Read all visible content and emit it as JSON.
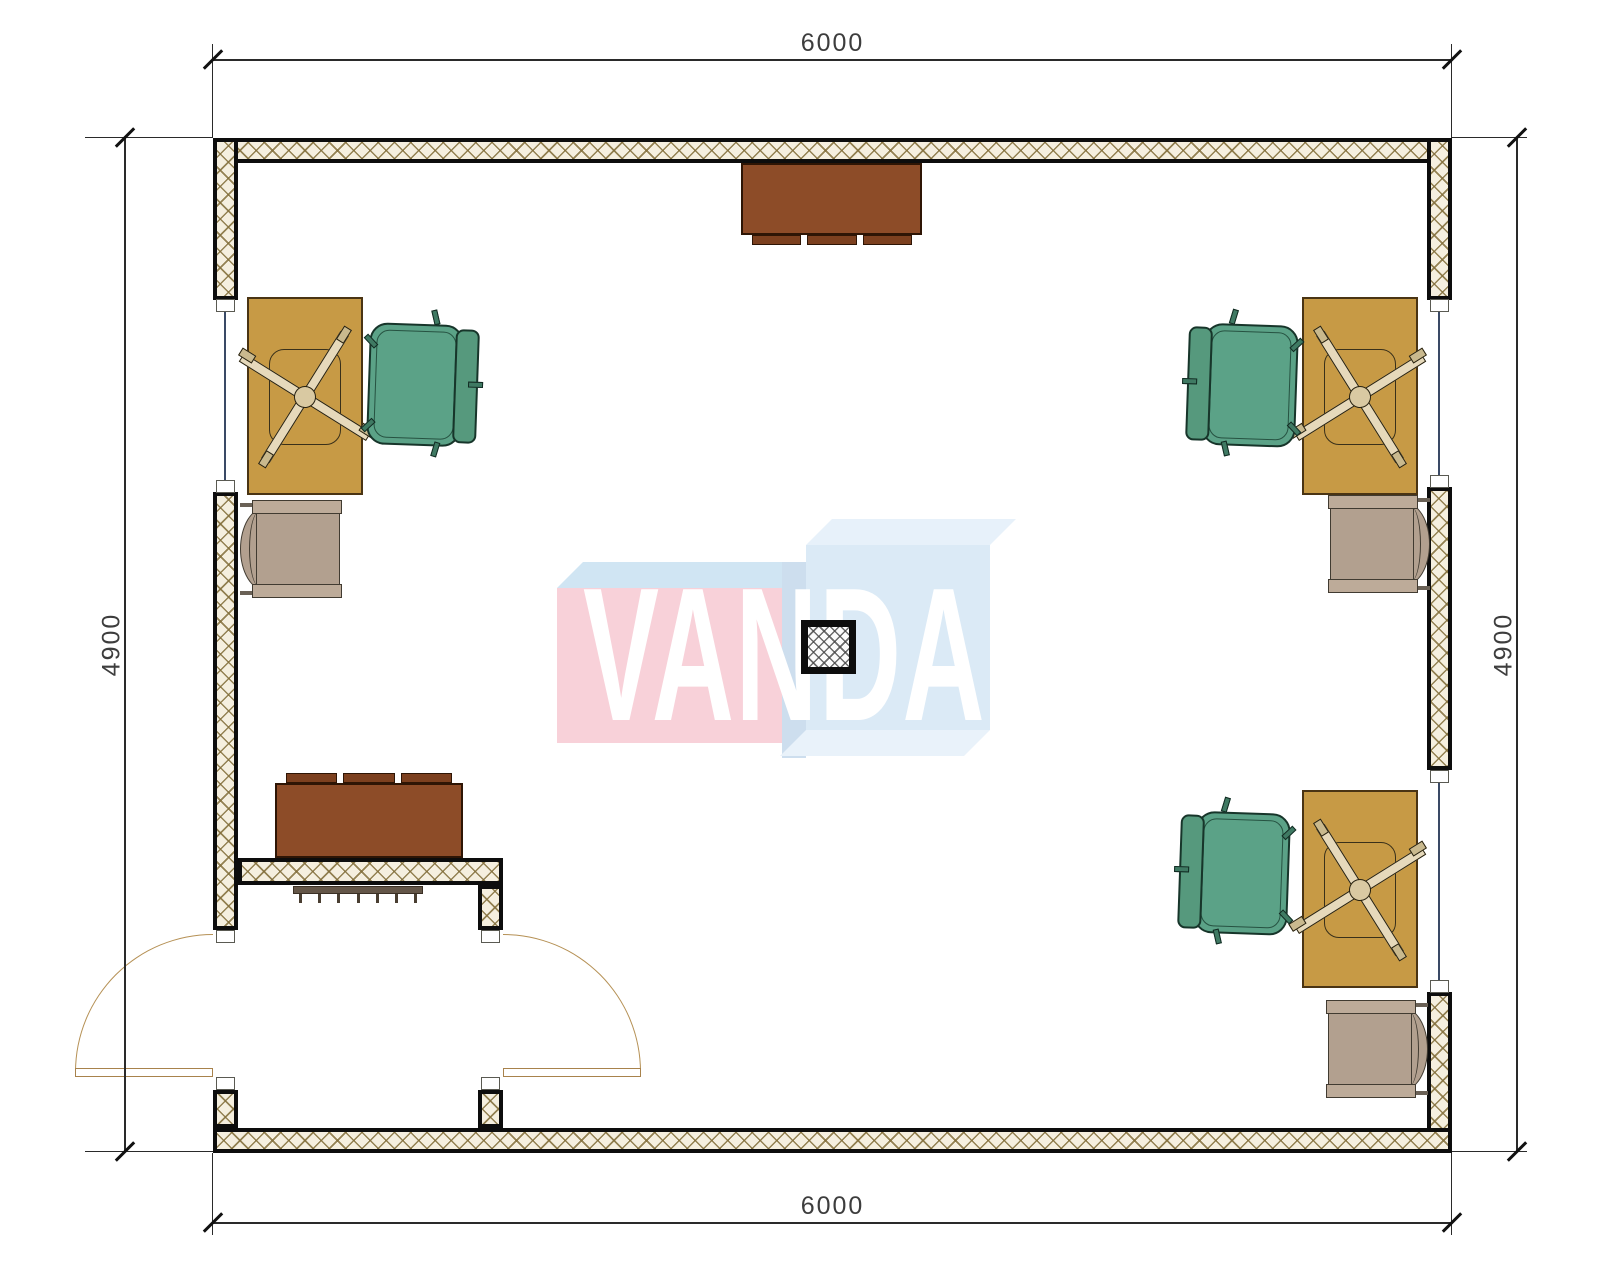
{
  "dimensions": {
    "top": "6000",
    "bottom": "6000",
    "left": "4900",
    "right": "4900",
    "unit_note": "mm"
  },
  "watermark": {
    "text": "VANDA",
    "text_color": "#ffffff",
    "left_box_front_color": "#f8d1d9",
    "left_box_top_color": "#d0e5f3",
    "middle_side_color": "#cddeee",
    "right_box_front_color": "#dbeaf6",
    "right_box_top_color": "#e7f1fa"
  },
  "colors": {
    "wall_hatch_bg": "#f5efdf",
    "wall_hatch_line": "#826e3a",
    "wall_border": "#0d0d0d",
    "window_glass_line": "#3a4a66",
    "door_swing": "#b59054",
    "desk_top": "#c79a45",
    "office_chair_green": "#5ba287",
    "armchair_taupe": "#b2a08f",
    "cabinet_brown": "#8d4c28",
    "radiator": "#645648",
    "dimension_line": "#2a2a2a"
  },
  "furniture": [
    {
      "type": "sideboard-cabinet",
      "location": "top-center",
      "count": 1
    },
    {
      "type": "sideboard-cabinet",
      "location": "entry-vestibule",
      "count": 1
    },
    {
      "type": "desk-with-task-chair-base",
      "location": "left-top / right-top / right-bottom",
      "count": 3
    },
    {
      "type": "executive-swivel-chair",
      "location": "beside each desk",
      "count": 3
    },
    {
      "type": "armchair",
      "location": "left-middle / right-middle / right-bottom",
      "count": 3
    },
    {
      "type": "radiator",
      "location": "vestibule-wall",
      "count": 1
    },
    {
      "type": "structural-column",
      "location": "room-center",
      "count": 1
    },
    {
      "type": "double-leaf-entry-doors",
      "location": "bottom-left",
      "count": 2
    },
    {
      "type": "window",
      "location": "left-wall x1, right-wall x2",
      "count": 3
    }
  ]
}
